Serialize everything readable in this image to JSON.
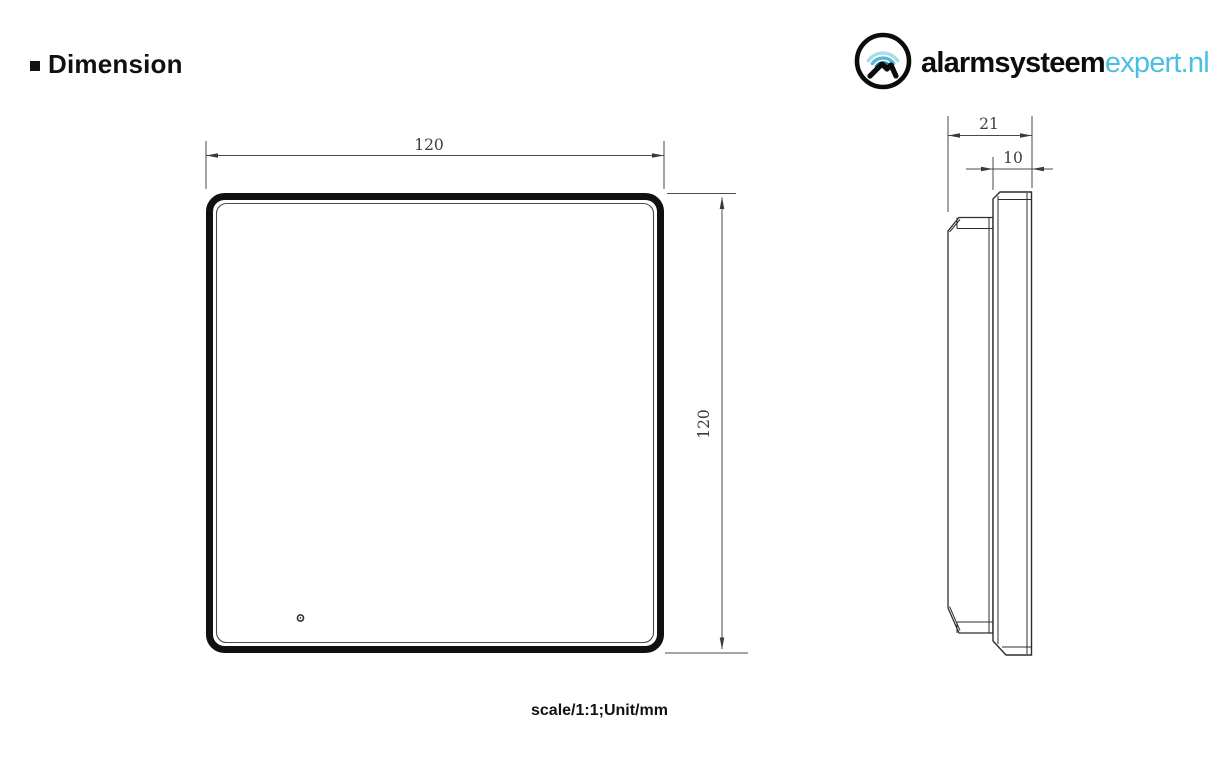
{
  "header": {
    "title": "Dimension"
  },
  "logo": {
    "brand_primary": "alarmsysteem",
    "brand_secondary": "expert.nl",
    "accent_color": "#4bbfe3"
  },
  "drawing": {
    "front_view": {
      "width_label": "120",
      "height_label": "120"
    },
    "side_view": {
      "total_depth_label": "21",
      "front_depth_label": "10"
    },
    "scale_note": "scale/1:1;Unit/mm"
  },
  "colors": {
    "thin_line": "#3a3a3a",
    "thick_outline": "#101010",
    "dim_text": "#3d3d3d"
  }
}
